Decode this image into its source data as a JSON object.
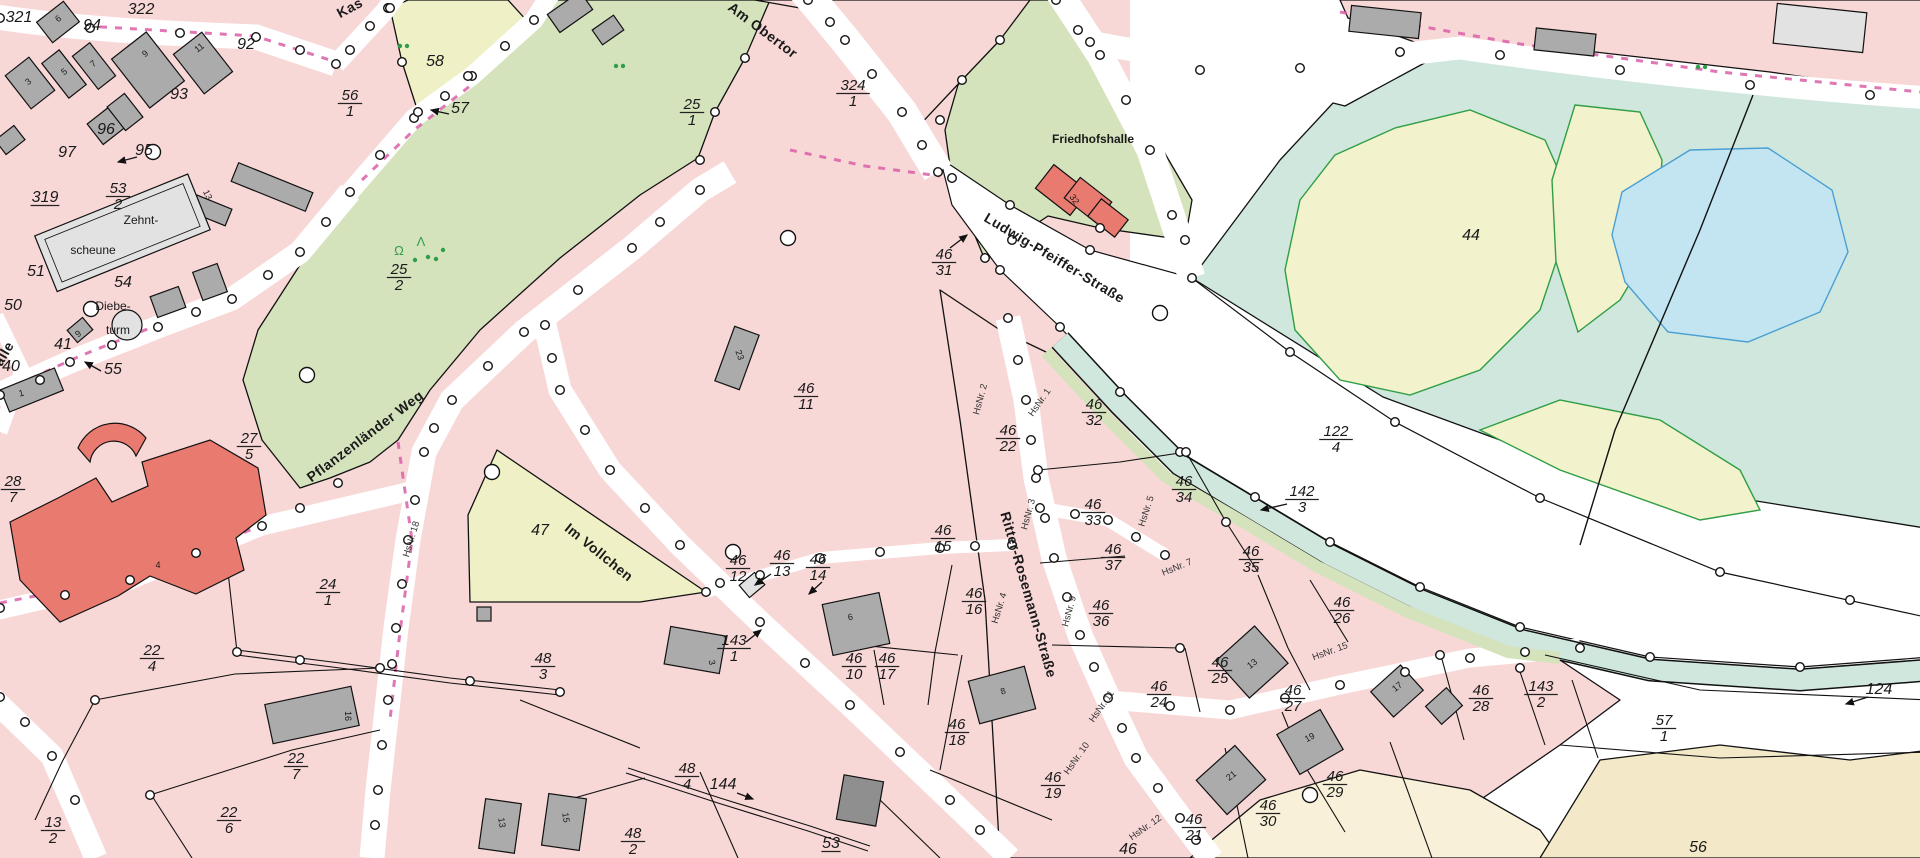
{
  "map": {
    "colors": {
      "parcel_pink": "#f8d7d7",
      "road_white": "#ffffff",
      "meadow_green": "#d5e3bd",
      "field_yellow": "#eff0c5",
      "water_teal": "#cfe7dc",
      "area_yellow": "#f2f2cd",
      "pond_blue": "#c3e5f2",
      "pond_stroke": "#4a9fd4",
      "area_green_stroke": "#2f9e44",
      "cream": "#f5edd2",
      "building_gray": "#ababab",
      "building_light": "#e2e2e2",
      "building_red": "#e97a70",
      "boundary_dash_pink": "#d95fa8",
      "vegetation_green": "#2e9e4a"
    },
    "street_labels": [
      [
        "Kas",
        352,
        12,
        -28
      ],
      [
        "Am Obertor",
        760,
        34,
        37
      ],
      [
        "Ludwig-Pfeiffer-Straße",
        1052,
        262,
        31
      ],
      [
        "Pflanzenländer Weg",
        368,
        440,
        -37
      ],
      [
        "Im Vollchen",
        596,
        556,
        39
      ],
      [
        "Ritter-Rosemann-Straße",
        1024,
        596,
        74
      ],
      [
        "alle",
        8,
        356,
        -60
      ]
    ],
    "place_labels": [
      [
        "Friedhofshalle",
        1093,
        143
      ],
      [
        "Zehnt-",
        141,
        224
      ],
      [
        "scheune",
        93,
        254
      ],
      [
        "Diebe-",
        113,
        310
      ],
      [
        "turm",
        118,
        334
      ]
    ],
    "parcel_fractions": [
      [
        "53",
        "2",
        118,
        196
      ],
      [
        "56",
        "1",
        350,
        103
      ],
      [
        "25",
        "1",
        692,
        112
      ],
      [
        "25",
        "2",
        399,
        277
      ],
      [
        "324",
        "1",
        853,
        93
      ],
      [
        "46",
        "31",
        944,
        262
      ],
      [
        "46",
        "11",
        806,
        396
      ],
      [
        "27",
        "5",
        249,
        446
      ],
      [
        "28",
        "7",
        13,
        489
      ],
      [
        "22",
        "4",
        152,
        658
      ],
      [
        "24",
        "1",
        328,
        592
      ],
      [
        "22",
        "7",
        296,
        766
      ],
      [
        "22",
        "6",
        229,
        820
      ],
      [
        "13",
        "2",
        53,
        830
      ],
      [
        "48",
        "3",
        543,
        666
      ],
      [
        "143",
        "1",
        734,
        648
      ],
      [
        "46",
        "12",
        738,
        568
      ],
      [
        "46",
        "13",
        782,
        563
      ],
      [
        "46",
        "14",
        818,
        567
      ],
      [
        "46",
        "15",
        943,
        538
      ],
      [
        "46",
        "16",
        974,
        601
      ],
      [
        "46",
        "10",
        854,
        666
      ],
      [
        "46",
        "17",
        887,
        666
      ],
      [
        "46",
        "18",
        957,
        732
      ],
      [
        "46",
        "19",
        1053,
        785
      ],
      [
        "48",
        "4",
        687,
        776
      ],
      [
        "48",
        "2",
        633,
        841
      ],
      [
        "46",
        "22",
        1008,
        438
      ],
      [
        "46",
        "32",
        1094,
        412
      ],
      [
        "46",
        "33",
        1093,
        512
      ],
      [
        "46",
        "34",
        1184,
        489
      ],
      [
        "46",
        "35",
        1251,
        559
      ],
      [
        "46",
        "37",
        1113,
        557
      ],
      [
        "46",
        "36",
        1101,
        613
      ],
      [
        "46",
        "25",
        1220,
        670
      ],
      [
        "46",
        "26",
        1342,
        610
      ],
      [
        "46",
        "24",
        1159,
        694
      ],
      [
        "46",
        "27",
        1293,
        698
      ],
      [
        "46",
        "28",
        1481,
        698
      ],
      [
        "143",
        "2",
        1541,
        694
      ],
      [
        "46",
        "29",
        1335,
        784
      ],
      [
        "46",
        "30",
        1268,
        813
      ],
      [
        "46",
        "21",
        1194,
        827
      ],
      [
        "122",
        "4",
        1336,
        439
      ],
      [
        "142",
        "3",
        1302,
        499
      ],
      [
        "57",
        "1",
        1664,
        728
      ]
    ],
    "plain_numbers": [
      [
        "322",
        141,
        14,
        0
      ],
      [
        "321",
        19,
        22,
        0
      ],
      [
        "94",
        92,
        30,
        0
      ],
      [
        "92",
        246,
        49,
        0
      ],
      [
        "93",
        179,
        99,
        0
      ],
      [
        "96",
        106,
        134,
        0
      ],
      [
        "97",
        67,
        157,
        0
      ],
      [
        "95",
        144,
        155,
        0
      ],
      [
        "319",
        45,
        202,
        1
      ],
      [
        "51",
        36,
        276,
        0
      ],
      [
        "50",
        13,
        310,
        0
      ],
      [
        "54",
        123,
        287,
        0
      ],
      [
        "40",
        11,
        371,
        0
      ],
      [
        "41",
        63,
        349,
        0
      ],
      [
        "55",
        113,
        374,
        0
      ],
      [
        "58",
        435,
        66,
        0
      ],
      [
        "57",
        460,
        113,
        0
      ],
      [
        "47",
        540,
        535,
        0
      ],
      [
        "44",
        1471,
        240,
        0
      ],
      [
        "53",
        831,
        848,
        1
      ],
      [
        "46",
        1128,
        854,
        0
      ],
      [
        "56",
        1698,
        852,
        0
      ],
      [
        "144",
        723,
        789,
        0
      ],
      [
        "124",
        1879,
        694,
        0
      ]
    ],
    "house_numbers": [
      [
        "HsNr. 18",
        414,
        540,
        -73
      ],
      [
        "HsNr. 2",
        983,
        400,
        -75
      ],
      [
        "HsNr. 1",
        1042,
        404,
        -55
      ],
      [
        "HsNr. 3",
        1031,
        515,
        -75
      ],
      [
        "HsNr. 4",
        1002,
        609,
        -73
      ],
      [
        "HsNr. 5",
        1149,
        512,
        -72
      ],
      [
        "HsNr. 7",
        1178,
        570,
        -22
      ],
      [
        "HsNr. 9",
        1072,
        612,
        -75
      ],
      [
        "HsNr. 11",
        1104,
        708,
        -55
      ],
      [
        "HsNr. 10",
        1079,
        760,
        -55
      ],
      [
        "HsNr. 12",
        1147,
        830,
        -35
      ],
      [
        "HsNr. 15",
        1331,
        654,
        -20
      ]
    ],
    "building_numbers": [
      [
        "3",
        30,
        84,
        -38
      ],
      [
        "5",
        66,
        74,
        -38
      ],
      [
        "7",
        95,
        66,
        -38
      ],
      [
        "9",
        147,
        56,
        -38
      ],
      [
        "11",
        201,
        50,
        -38
      ],
      [
        "6",
        60,
        21,
        -38
      ],
      [
        "13",
        205,
        196,
        65
      ],
      [
        "1",
        22,
        396,
        -15
      ],
      [
        "9",
        80,
        336,
        -40
      ],
      [
        "23",
        737,
        356,
        70
      ],
      [
        "32",
        1072,
        201,
        55
      ],
      [
        "4",
        158,
        568,
        0
      ],
      [
        "16",
        345,
        716,
        90
      ],
      [
        "3",
        709,
        663,
        80
      ],
      [
        "6",
        851,
        620,
        -12
      ],
      [
        "8",
        1004,
        694,
        -18
      ],
      [
        "13",
        1254,
        666,
        -38
      ],
      [
        "17",
        1399,
        689,
        -38
      ],
      [
        "19",
        1311,
        740,
        -28
      ],
      [
        "21",
        1233,
        778,
        -38
      ],
      [
        "15",
        563,
        818,
        82
      ],
      [
        "13",
        499,
        823,
        82
      ]
    ],
    "arrows": [
      [
        137,
        157,
        118,
        162
      ],
      [
        101,
        371,
        85,
        362
      ],
      [
        449,
        114,
        431,
        110
      ],
      [
        950,
        248,
        967,
        235
      ],
      [
        771,
        574,
        755,
        585
      ],
      [
        822,
        582,
        809,
        594
      ],
      [
        746,
        642,
        761,
        630
      ],
      [
        1287,
        504,
        1261,
        510
      ],
      [
        1868,
        697,
        1846,
        704
      ],
      [
        737,
        793,
        753,
        799
      ]
    ],
    "veg_glyphs": [
      [
        "Ω",
        399,
        255
      ],
      [
        "Λ",
        421,
        246
      ]
    ],
    "veg_dots": [
      [
        400,
        46
      ],
      [
        407,
        46
      ],
      [
        616,
        66
      ],
      [
        623,
        66
      ],
      [
        1698,
        67
      ],
      [
        1705,
        67
      ],
      [
        428,
        257
      ],
      [
        436,
        259
      ],
      [
        415,
        260
      ],
      [
        443,
        250
      ]
    ]
  }
}
